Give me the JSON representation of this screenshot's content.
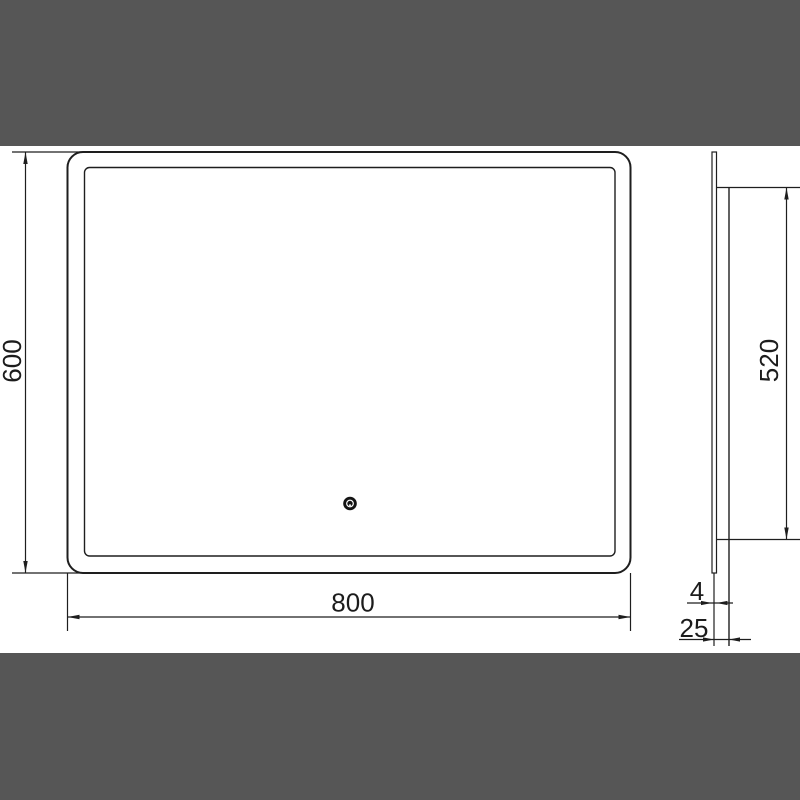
{
  "page": {
    "title": "Mirror technical dimension drawing"
  },
  "colors": {
    "band": "#565656",
    "line": "#1e1e1e",
    "background": "#ffffff",
    "sensor": "#141414"
  },
  "drawing": {
    "front_view": {
      "width_label": "800",
      "height_label": "600"
    },
    "side_view": {
      "height_label": "520",
      "thickness_label": "4",
      "depth_label": "25"
    },
    "icons": {
      "touch_sensor": "touch-sensor-dot"
    }
  }
}
